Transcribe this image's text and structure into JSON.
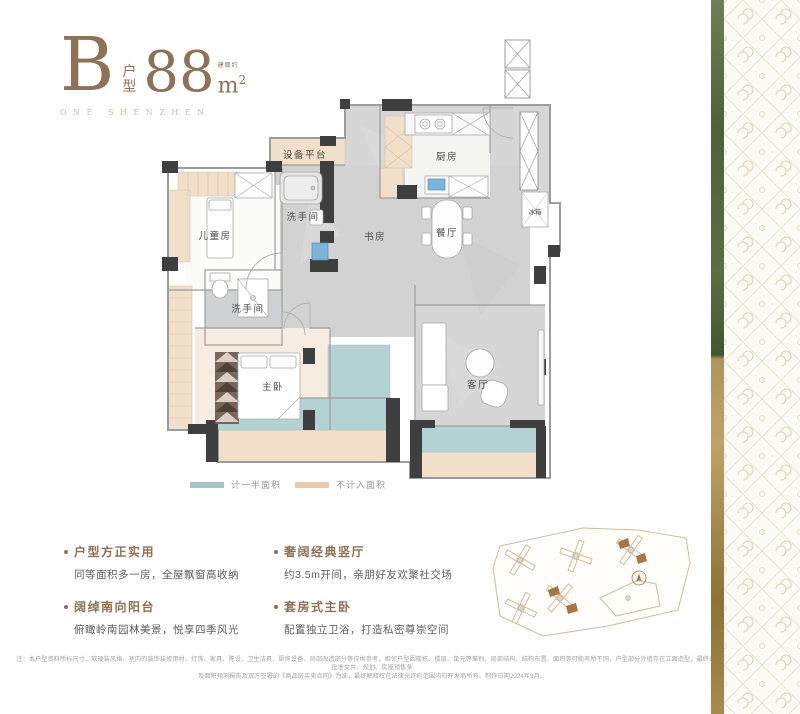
{
  "title": {
    "letter": "B",
    "type_chars": [
      "户",
      "型"
    ],
    "area_value": "88",
    "area_prefix": "建面约",
    "area_unit_base": "m",
    "area_unit_sup": "2",
    "subtitle": "ONE SHENZHEN"
  },
  "floorplan": {
    "rooms": [
      {
        "id": "equipment-platform",
        "label": "设备平台"
      },
      {
        "id": "kids-room",
        "label": "儿童房"
      },
      {
        "id": "bathroom-1",
        "label": "洗手间"
      },
      {
        "id": "study",
        "label": "书房"
      },
      {
        "id": "kitchen",
        "label": "厨房"
      },
      {
        "id": "dining-room",
        "label": "餐厅"
      },
      {
        "id": "fridge",
        "label": "冰箱"
      },
      {
        "id": "bathroom-2",
        "label": "洗手间"
      },
      {
        "id": "master-bedroom",
        "label": "主卧"
      },
      {
        "id": "living-room",
        "label": "客厅"
      }
    ]
  },
  "legend": {
    "items": [
      {
        "label": "计一半面积",
        "color": "#a5c6c7"
      },
      {
        "label": "不计入面积",
        "color": "#ecc9ab"
      }
    ]
  },
  "features": [
    {
      "heading": "户型方正实用",
      "body": "同等面积多一房，全屋飘窗高收纳"
    },
    {
      "heading": "奢阔经典竖厅",
      "body": "约3.5m开间，亲朋好友欢聚社交场"
    },
    {
      "heading": "阔绰南向阳台",
      "body": "俯瞰岭南园林美景，悦享四季风光"
    },
    {
      "heading": "套房式主卧",
      "body": "配置独立卫浴，打造私密尊崇空间"
    }
  ],
  "fine_print": {
    "line1": "注：本户型资料所标尺寸、软硬装风格、室内的装饰装修用材、灯饰、家具、陈设、卫生洁具、厨房设备、局部改造部分等仅供参考，相邻户型因楼栋、楼层、单元等差别，局部结构、结构布置、面积等可能有所不同，户型部分外墙存在立面造型，最终以政府批准文件、规划、房屋预售条",
    "line2": "及面积预测报告及双方签署的《商品房买卖合同》为准，最终解释权在法律允许的范围内归开发商所有。制作日期2024年9月。"
  },
  "colors": {
    "brand_brown": "#8e7256",
    "subtitle_tan": "#cfb99d",
    "legend_teal": "#a5c6c7",
    "legend_tan": "#ecc9ab",
    "plan_wall_dark": "#3f3f3f",
    "plan_floor_gray": "#d5d5d5",
    "plan_tan": "#f1dfc9",
    "plan_teal": "#b4d2d3",
    "strip_green": "#4b6338",
    "strip_gold": "#a9894c",
    "site_outline": "#d2bb9b",
    "site_highlight": "#a6764a"
  }
}
